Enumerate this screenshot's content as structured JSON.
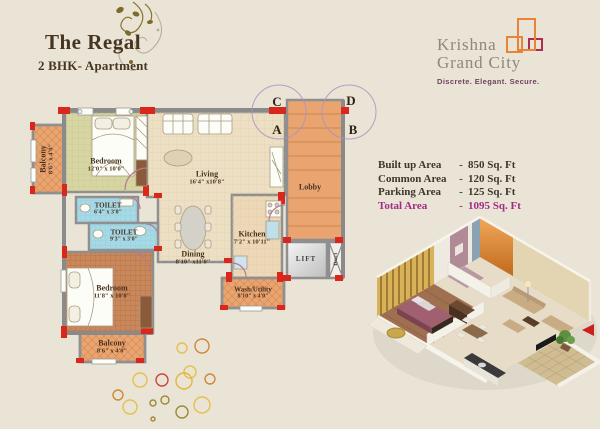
{
  "header": {
    "title": "The Regal",
    "subtitle": "2 BHK- Apartment"
  },
  "brand": {
    "name_line1": "Krishna",
    "name_line2": "Grand City",
    "tagline": "Discrete. Elegant. Secure.",
    "colors": {
      "orange": "#e8833a",
      "magenta": "#ab2d52",
      "text_gray": "#8d8781",
      "tagline_purple": "#6d4460"
    }
  },
  "areas": {
    "rows": [
      {
        "label": "Built up Area",
        "sep": "-",
        "value": "850 Sq. Ft"
      },
      {
        "label": "Common Area",
        "sep": "-",
        "value": "120 Sq. Ft"
      },
      {
        "label": "Parking Area",
        "sep": "-",
        "value": "125 Sq. Ft"
      },
      {
        "label": "Total Area",
        "sep": "-",
        "value": "1095 Sq. Ft"
      }
    ],
    "highlight_color": "#a02a85"
  },
  "plan": {
    "markers": {
      "c": "C",
      "d": "D",
      "a": "A",
      "b": "B"
    },
    "rooms": {
      "balcony1": {
        "name": "Balcony",
        "dims": "8'6\" x 4'0\""
      },
      "bedroom1": {
        "name": "Bedroom",
        "dims": "12'0\" x 10'0\""
      },
      "living": {
        "name": "Living",
        "dims": "16'4\" x10'8\""
      },
      "toilet1": {
        "name": "TOILET",
        "dims": "6'4\" x 3'8\""
      },
      "toilet2": {
        "name": "TOILET",
        "dims": "9'3\" x 3'0\""
      },
      "dining": {
        "name": "Dining",
        "dims": "8'10\" x11'0\""
      },
      "bedroom2": {
        "name": "Bedroom",
        "dims": "11'8\" x 10'8\""
      },
      "balcony2": {
        "name": "Balcony",
        "dims": "8'6\" x 4'0\""
      },
      "kitchen": {
        "name": "Kitchen",
        "dims": "7'2\" x 10'11\""
      },
      "wash": {
        "name": "Wash/Utility",
        "dims": "8'10\" x 4'0\""
      },
      "lobby": {
        "name": "Lobby"
      },
      "lift": {
        "name": "LIFT"
      },
      "duct": {
        "name": "Duct"
      }
    }
  }
}
